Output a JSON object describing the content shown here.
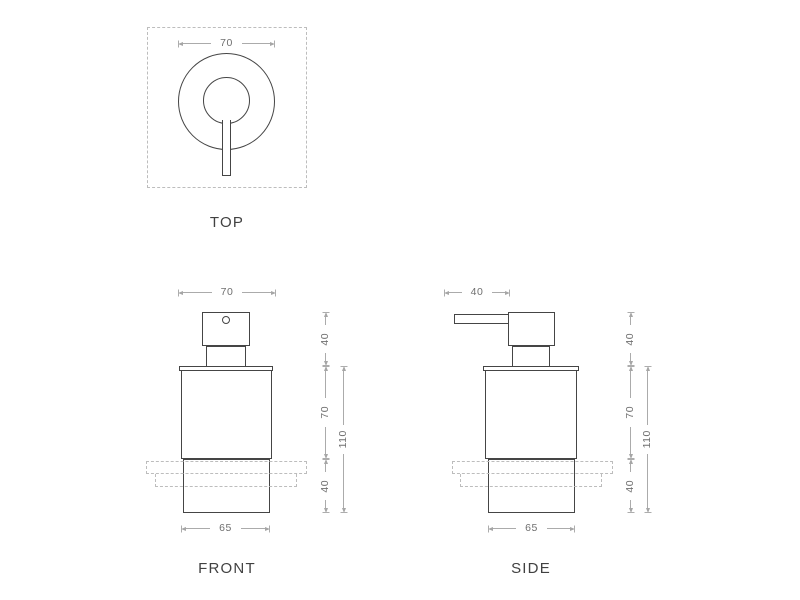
{
  "drawing": {
    "type": "soap-dispenser-technical-drawing",
    "colors": {
      "background": "#ffffff",
      "outline": "#454545",
      "dimension_line": "#ababab",
      "dimension_text": "#6f6f6f",
      "dashed_line": "#bdbdbd",
      "label_text": "#414141"
    }
  },
  "views": {
    "top": {
      "label": "TOP",
      "dim_width": "70"
    },
    "front": {
      "label": "FRONT",
      "dim_width": "70",
      "dim_base_width": "65",
      "dim_pump_height": "40",
      "dim_body_height": "70",
      "dim_total_height": "110",
      "dim_holder_height": "40"
    },
    "side": {
      "label": "SIDE",
      "dim_spout_depth": "40",
      "dim_base_width": "65",
      "dim_pump_height": "40",
      "dim_body_height": "70",
      "dim_total_height": "110",
      "dim_holder_height": "40"
    }
  }
}
